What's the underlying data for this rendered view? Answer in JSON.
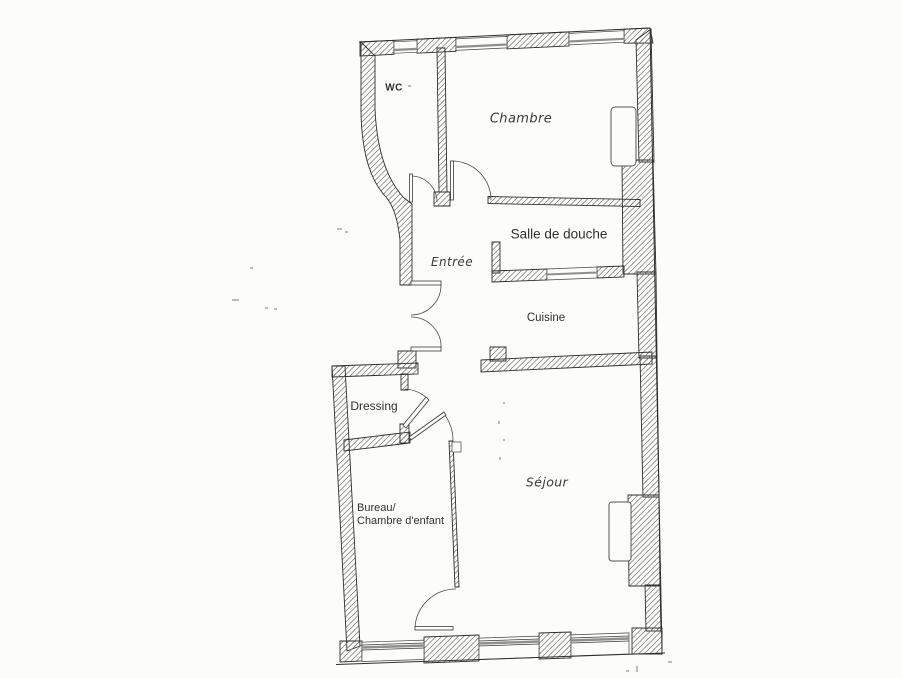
{
  "document": {
    "type": "floor-plan-scan"
  },
  "rooms": {
    "wc": {
      "label": "WC"
    },
    "chambre": {
      "label": "Chambre"
    },
    "salle_de_douche": {
      "label": "Salle de douche"
    },
    "entree": {
      "label": "Entrée"
    },
    "cuisine": {
      "label": "Cuisine"
    },
    "dressing": {
      "label": "Dressing"
    },
    "bureau": {
      "label_line1": "Bureau/",
      "label_line2": "Chambre d'enfant"
    },
    "sejour": {
      "label": "Séjour"
    }
  },
  "colors": {
    "paper": "#fcfcfa",
    "ink": "#2e2e2e",
    "hatch": "#777777",
    "door_arc": "#4a4a4a",
    "glazing": "#8f8f8f"
  }
}
